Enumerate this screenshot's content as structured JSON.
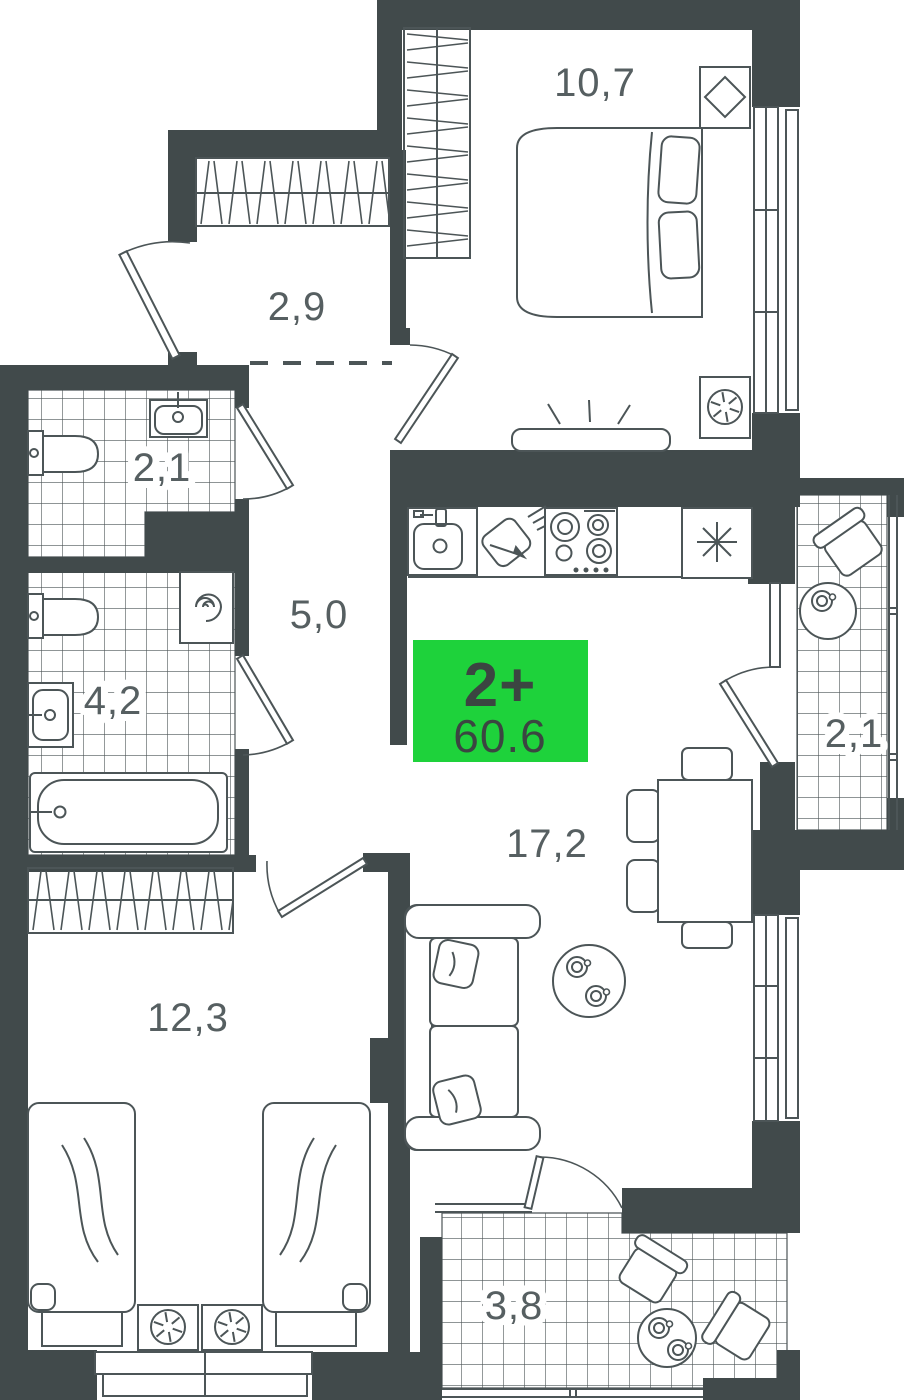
{
  "plan": {
    "type_badge": {
      "rooms_label": "2+",
      "area_label": "60.6",
      "bg": "#1ED23B",
      "text_color": "#3B4541"
    },
    "colors": {
      "wall": "#414A4B",
      "line": "#4C5557",
      "label": "#565F61",
      "floor": "#FFFFFF",
      "tile_line": "#4C5557"
    },
    "rooms": [
      {
        "id": "bedroom-top",
        "area_label": "10,7"
      },
      {
        "id": "entry-hall",
        "area_label": "2,9"
      },
      {
        "id": "wc",
        "area_label": "2,1"
      },
      {
        "id": "corridor",
        "area_label": "5,0"
      },
      {
        "id": "bathroom",
        "area_label": "4,2"
      },
      {
        "id": "living-kitchen",
        "area_label": "17,2"
      },
      {
        "id": "bedroom-bottom",
        "area_label": "12,3"
      },
      {
        "id": "loggia-right",
        "area_label": "2,1"
      },
      {
        "id": "loggia-bottom",
        "area_label": "3,8"
      }
    ],
    "icons": [
      "wardrobe-icon",
      "double-bed-icon",
      "single-bed-icon",
      "nightstand-icon",
      "plant-icon",
      "picture-icon",
      "tv-icon",
      "kitchen-sink-icon",
      "cutting-board-icon",
      "stove-icon",
      "fridge-icon",
      "armchair-icon",
      "side-table-icon",
      "cup-icon",
      "sofa-icon",
      "pillow-icon",
      "coffee-table-icon",
      "dining-table-icon",
      "chair-icon",
      "toilet-icon",
      "washbasin-icon",
      "washing-machine-icon",
      "bathtub-icon",
      "window-icon",
      "door-icon",
      "entrance-door-icon"
    ]
  }
}
